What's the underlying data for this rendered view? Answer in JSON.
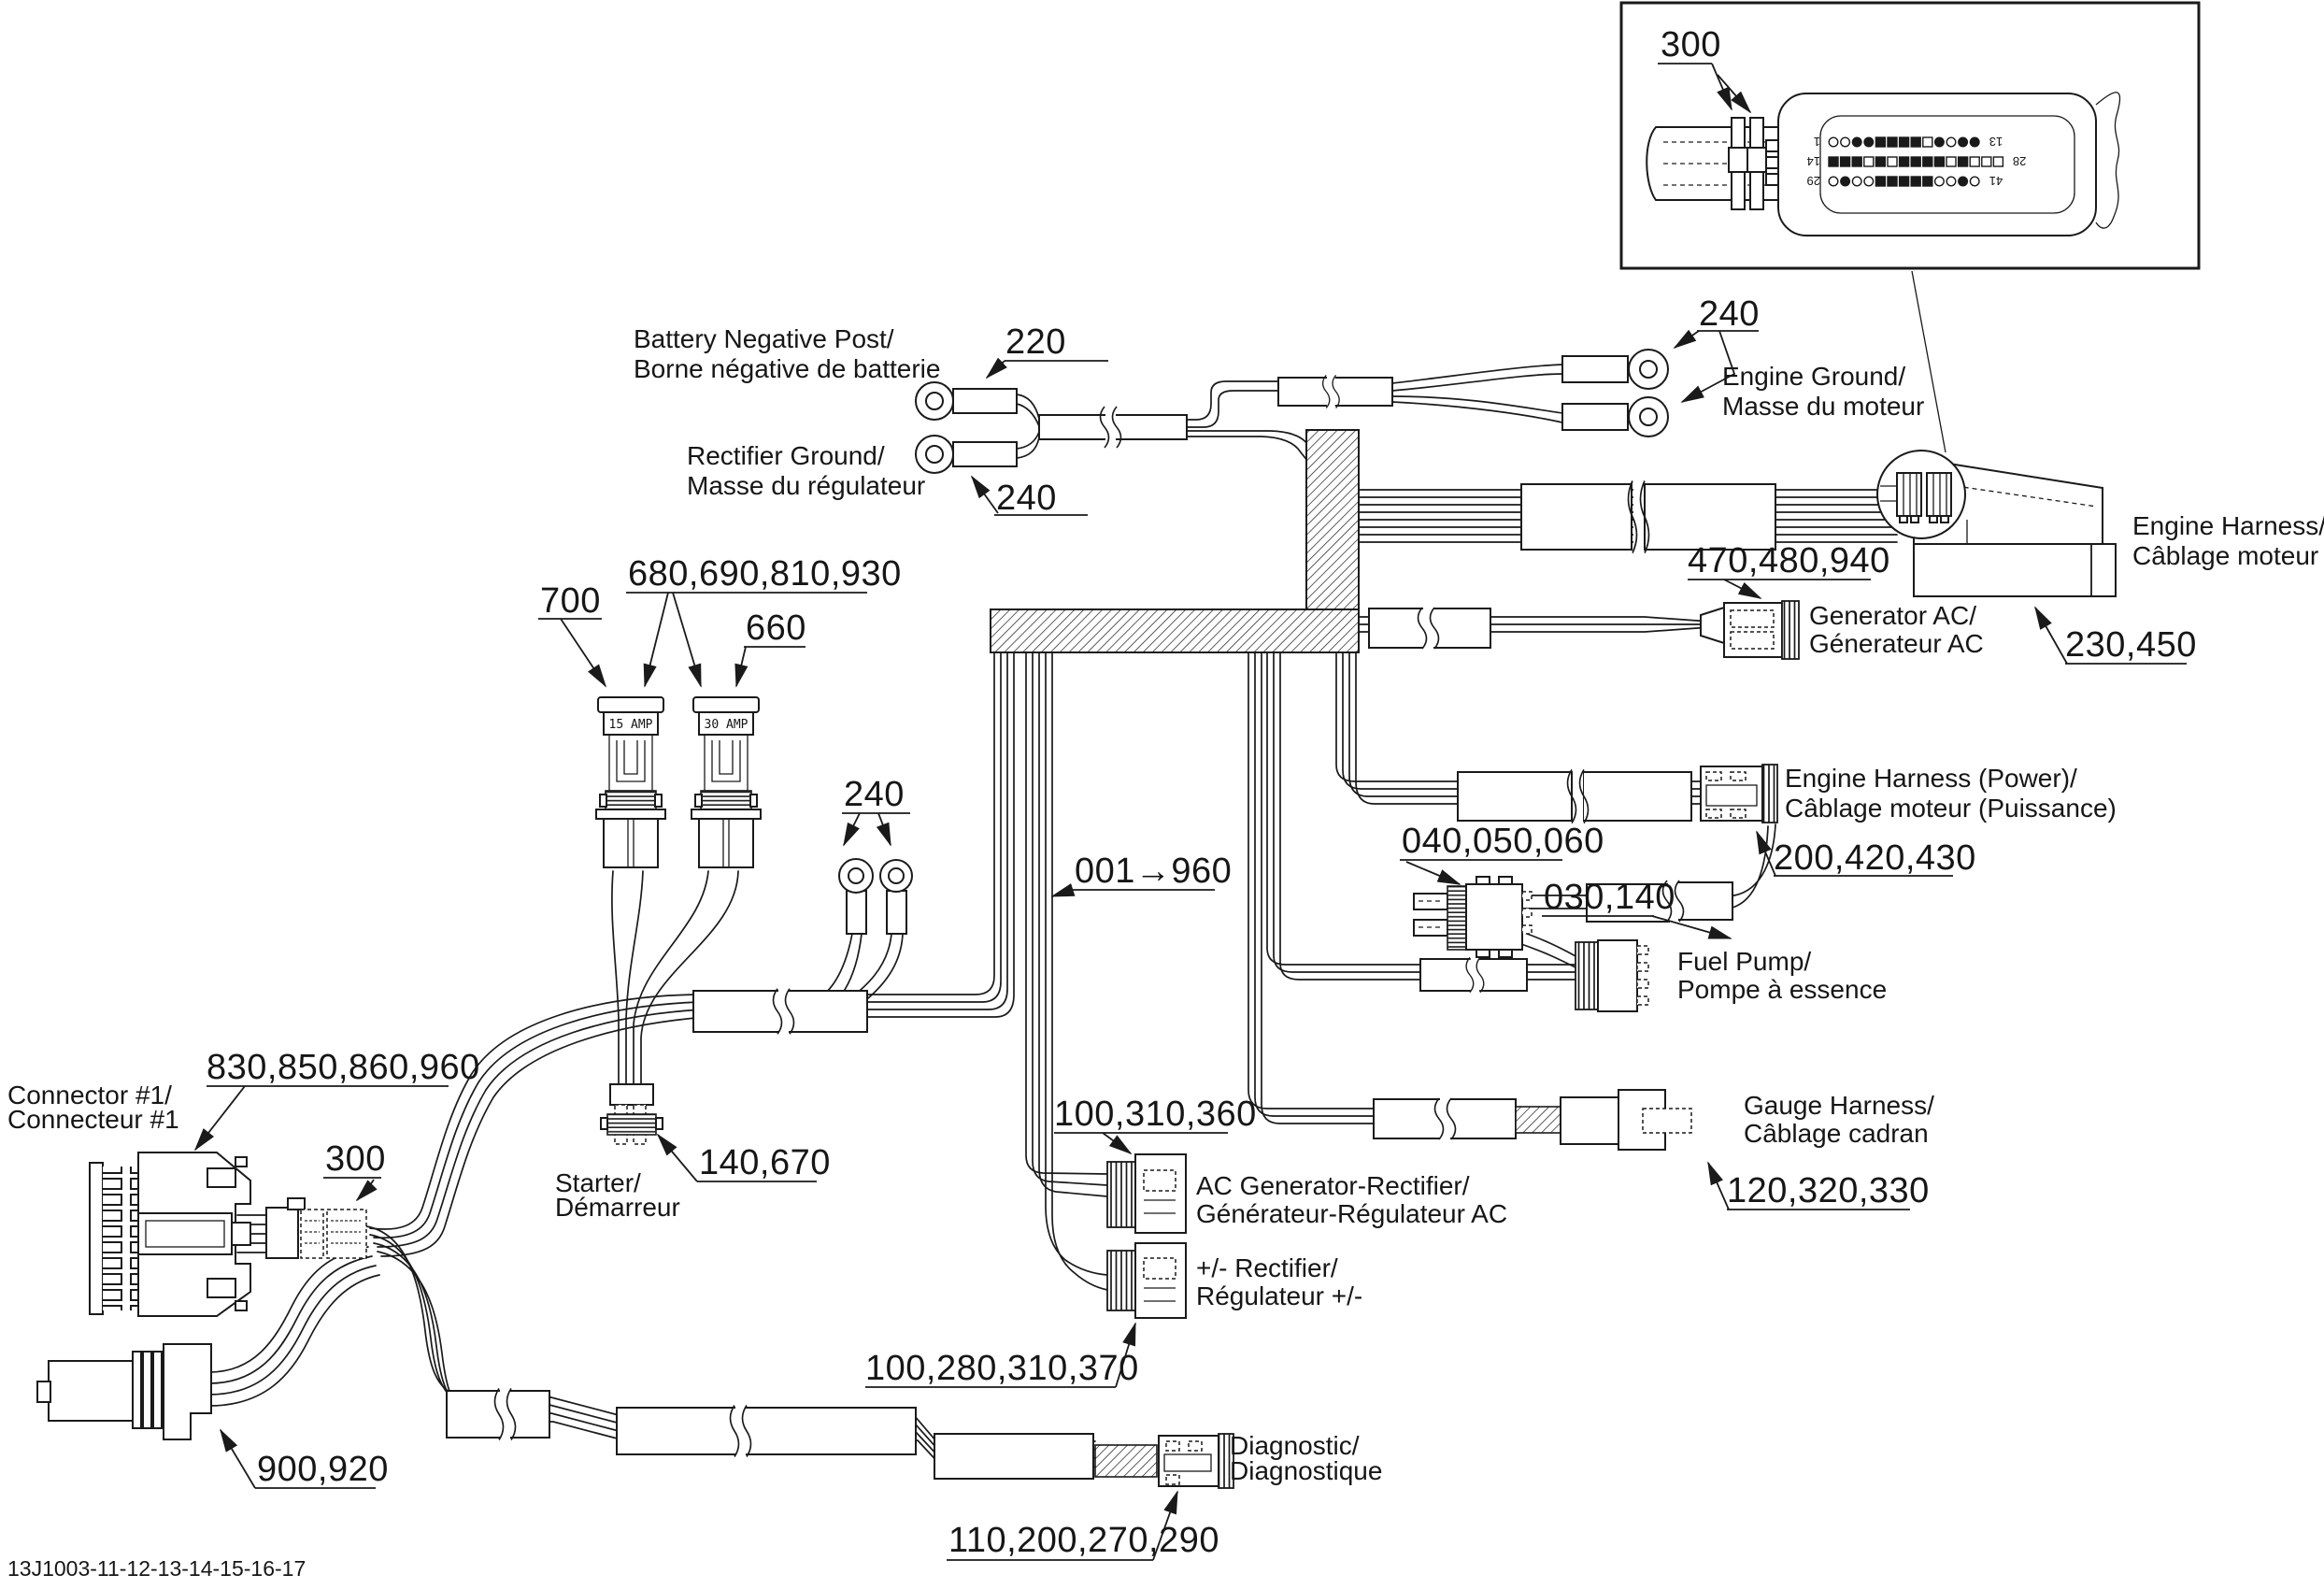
{
  "footer": {
    "code": "13J1003-11-12-13-14-15-16-17"
  },
  "inset": {
    "callout": "300",
    "rows": [
      {
        "left": "1",
        "right": "13",
        "pins": [
          "c",
          "c",
          "f",
          "f",
          "S",
          "S",
          "S",
          "S",
          "s",
          "f",
          "c",
          "f",
          "f"
        ]
      },
      {
        "left": "14",
        "right": "28",
        "pins": [
          "S",
          "S",
          "S",
          "s",
          "S",
          "s",
          "S",
          "S",
          "S",
          "S",
          "s",
          "S",
          "s",
          "s",
          "s"
        ]
      },
      {
        "left": "29",
        "right": "41",
        "pins": [
          "c",
          "f",
          "c",
          "c",
          "S",
          "S",
          "S",
          "S",
          "S",
          "c",
          "c",
          "f",
          "c"
        ]
      }
    ]
  },
  "fuse_text": {
    "left": "15 AMP",
    "right": "30 AMP"
  },
  "callouts": {
    "battery": "220",
    "rectifier_ground": "240",
    "engine_ground": "240",
    "mid_grounds": "240",
    "fuses_all": "680,690,810,930",
    "fuse_left": "700",
    "fuse_right": "660",
    "harness_span": "001→960",
    "generator_ac": "470,480,940",
    "engine_harness": "230,450",
    "engine_harness_power": "200,420,430",
    "inline_conn": "040,050,060",
    "fuel_pump": "030,140",
    "gauge_harness": "120,320,330",
    "ac_gen_rectifier": "100,310,360",
    "pm_rectifier": "100,280,310,370",
    "connector1": "830,850,860,960",
    "connector1_tag": "300",
    "starter": "140,670",
    "bottom_left_conn": "900,920",
    "diagnostic": "110,200,270,290"
  },
  "names": {
    "battery": {
      "en": "Battery Negative Post/",
      "fr": "Borne négative de batterie"
    },
    "rectifier_ground": {
      "en": "Rectifier Ground/",
      "fr": "Masse du régulateur"
    },
    "engine_ground": {
      "en": "Engine Ground/",
      "fr": "Masse du moteur"
    },
    "engine_harness": {
      "en": "Engine Harness/",
      "fr": "Câblage moteur"
    },
    "generator_ac": {
      "en": "Generator AC/",
      "fr": "Génerateur AC"
    },
    "engine_harness_power": {
      "en": "Engine Harness (Power)/",
      "fr": "Câblage moteur (Puissance)"
    },
    "fuel_pump": {
      "en": "Fuel Pump/",
      "fr": "Pompe à essence"
    },
    "gauge_harness": {
      "en": "Gauge Harness/",
      "fr": "Câblage cadran"
    },
    "ac_gen_rectifier": {
      "en": "AC Generator-Rectifier/",
      "fr": "Générateur-Régulateur AC"
    },
    "pm_rectifier": {
      "en": "+/- Rectifier/",
      "fr": "Régulateur +/-"
    },
    "connector1": {
      "en": "Connector #1/",
      "fr": "Connecteur #1"
    },
    "starter": {
      "en": "Starter/",
      "fr": "Démarreur"
    },
    "diagnostic": {
      "en": "Diagnostic/",
      "fr": "Diagnostique"
    }
  }
}
